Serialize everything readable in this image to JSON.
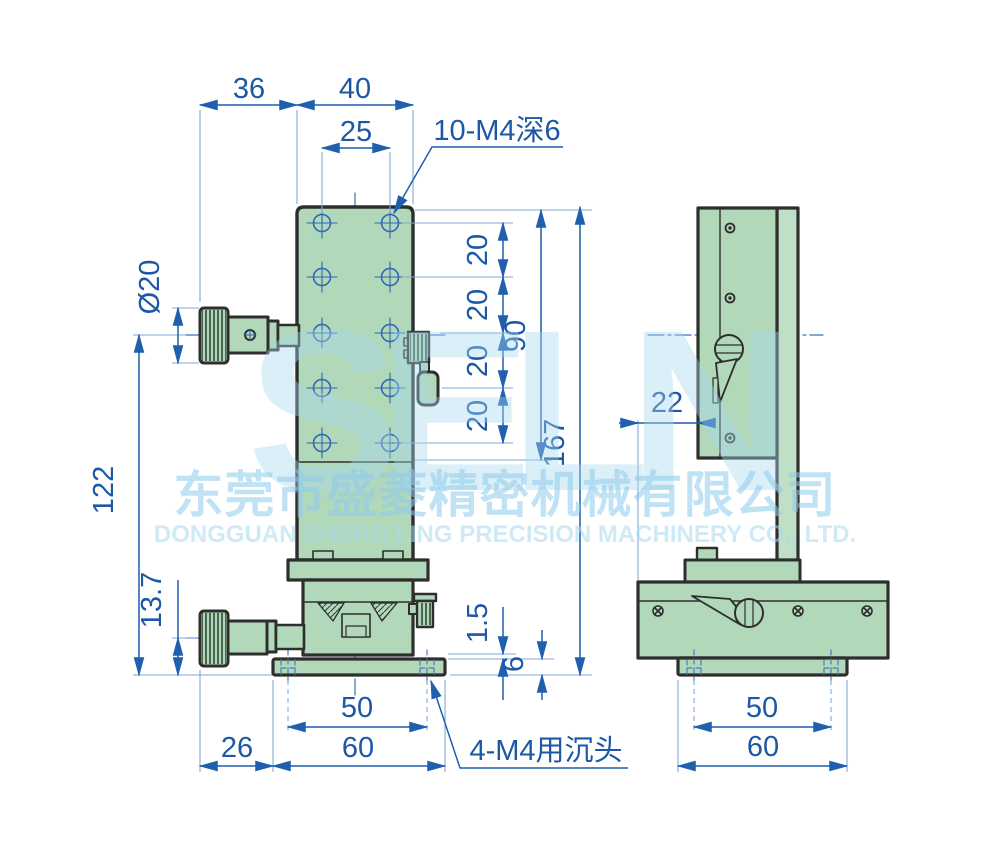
{
  "watermark": {
    "logo": "SELN",
    "company_cn": "东莞市盛菱精密机械有限公司",
    "company_en": "DONGGUAN SHENG LING PRECISION MACHINERY CO., LTD."
  },
  "colors": {
    "part_green": "#b2d8ba",
    "outline": "#2e2e2e",
    "dimension_blue": "#1d58a6",
    "watermark_blue": "#a8d8f0"
  },
  "front_view": {
    "dims": {
      "top_offset": "36",
      "top_width": "40",
      "hole_cc": "25",
      "thread_note": "10-M4深6",
      "knob_dia": "Ø20",
      "pitch": "20",
      "hole_span": "90",
      "total_height": "167",
      "knob_height": "122",
      "base_knob_height": "13.7",
      "step": "1.5",
      "flange_thk": "6",
      "cbore_cc": "50",
      "knob_offset": "26",
      "base_width": "60",
      "cbore_note": "4-M4用沉头"
    }
  },
  "side_view": {
    "dims": {
      "face_offset": "22",
      "cbore_cc": "50",
      "base_width": "60"
    }
  }
}
